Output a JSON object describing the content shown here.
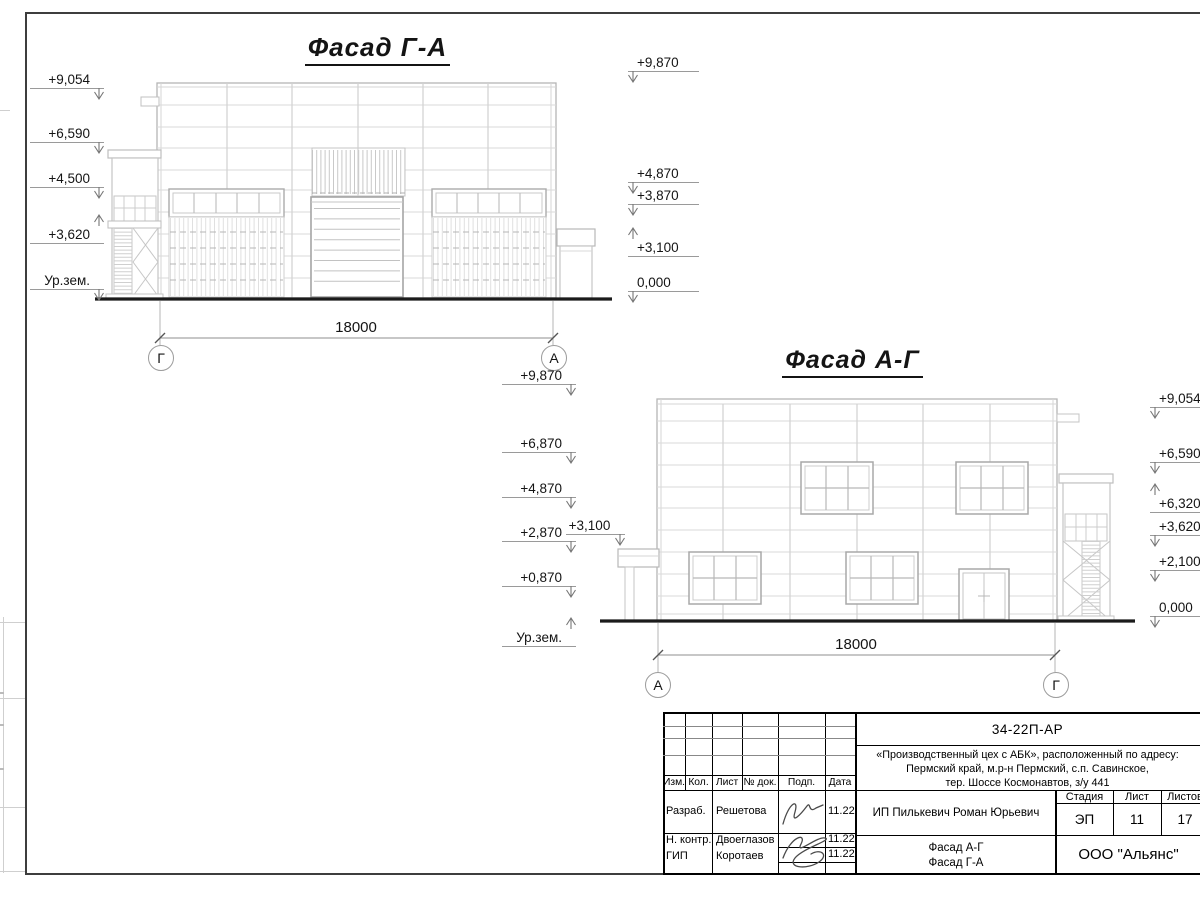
{
  "drawing": {
    "facade_ga": {
      "title": "Фасад Г-А",
      "dim": "18000",
      "axis_left": "Г",
      "axis_right": "А",
      "ml": [
        "+9,054",
        "+6,590",
        "+4,500",
        "+3,620",
        "Ур.зем."
      ],
      "mr": [
        "+9,870",
        "+4,870",
        "+3,870",
        "+3,100",
        "0,000"
      ]
    },
    "facade_ag": {
      "title": "Фасад А-Г",
      "dim": "18000",
      "axis_left": "А",
      "axis_right": "Г",
      "ml": [
        "+9,870",
        "+6,870",
        "+4,870",
        "+2,870",
        "+0,870",
        "Ур.зем."
      ],
      "canopy_mark": "+3,100",
      "mr": [
        "+9,054",
        "+6,590",
        "+6,320",
        "+3,620",
        "+2,100",
        "0,000"
      ]
    }
  },
  "titleblock": {
    "doc_number": "34-22П-АР",
    "project_line1": "«Производственный цех с АБК», расположенный по адресу:",
    "project_line2": "Пермский край, м.р-н Пермский, с.п. Савинское,",
    "project_line3": "тер. Шоссе Космонавтов, з/у 441",
    "col_izm": "Изм.",
    "col_kol": "Кол.",
    "col_list": "Лист",
    "col_ndok": "№ док.",
    "col_podp": "Подп.",
    "col_data": "Дата",
    "row1_role": "Разраб.",
    "row1_name": "Решетова",
    "row1_date": "11.22",
    "row2_role": "Н. контр.",
    "row2_name": "Двоеглазов",
    "row2_date": "11.22",
    "row3_role": "ГИП",
    "row3_name": "Коротаев",
    "row3_date": "11.22",
    "client": "ИП Пилькевич Роман Юрьевич",
    "stage_label": "Стадия",
    "list_label": "Лист",
    "listov_label": "Листов",
    "stage_value": "ЭП",
    "list_value": "11",
    "listov_value": "17",
    "content_line1": "Фасад А-Г",
    "content_line2": "Фасад Г-А",
    "organization": "ООО \"Альянс\""
  }
}
